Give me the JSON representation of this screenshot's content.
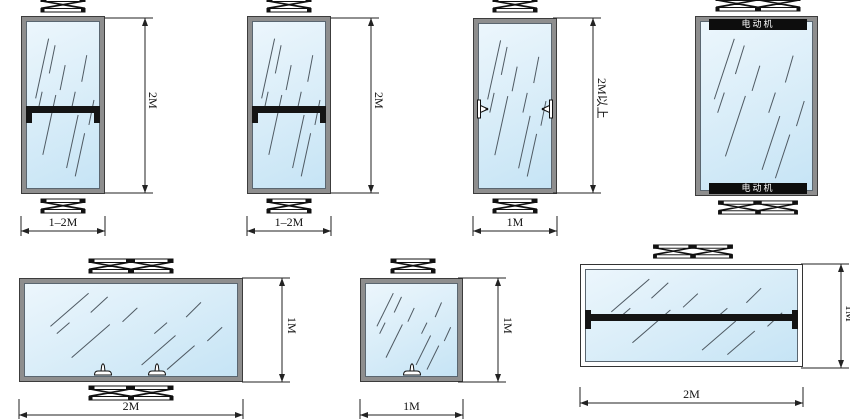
{
  "figures": {
    "f1": {
      "height": "2M",
      "width": "1–2M"
    },
    "f2": {
      "height": "2M",
      "width": "1–2M"
    },
    "f3": {
      "height": "2M以上",
      "width": "1M"
    },
    "f4": {
      "motor_top": "电动机",
      "motor_bottom": "电动机"
    },
    "f5": {
      "height": "1M",
      "width": "2M"
    },
    "f6": {
      "height": "1M",
      "width": "1M"
    },
    "f7": {
      "height": "1M",
      "width": "2M"
    }
  },
  "colors": {
    "background": "#ffffff",
    "glass_light": "#ecf6fc",
    "glass_dark": "#c6e4f5",
    "frame_gray": "#8e8e8e",
    "frame_outline": "#3c3c3c",
    "line_dark": "#141414",
    "motor_bar": "#0d0d0d",
    "motor_text": "#ffffff"
  }
}
